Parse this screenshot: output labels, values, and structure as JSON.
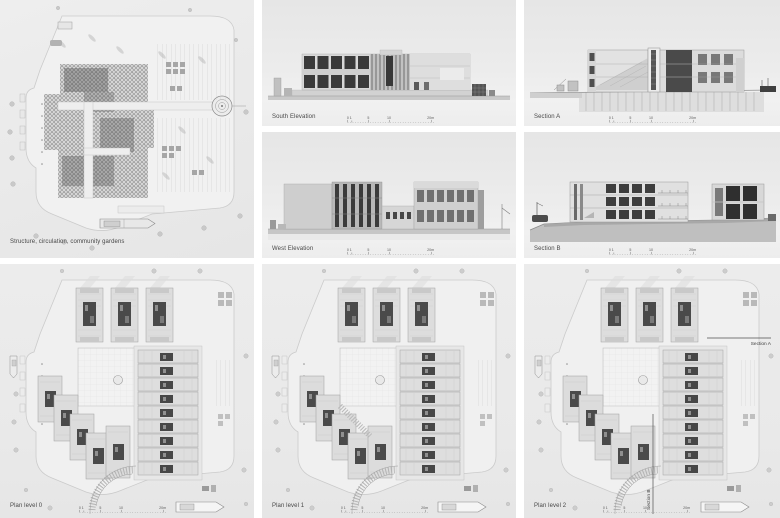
{
  "board": {
    "background": "#ffffff",
    "panel_background": "#ebebeb",
    "ink_color": "#474747",
    "dark_fill": "#434343"
  },
  "panels": {
    "axon": {
      "label": "Structure, circulation, community gardens"
    },
    "south_elevation": {
      "label": "South Elevation"
    },
    "west_elevation": {
      "label": "West Elevation"
    },
    "section_a": {
      "label": "Section A"
    },
    "section_b": {
      "label": "Section B"
    },
    "plan0": {
      "label": "Plan level 0"
    },
    "plan1": {
      "label": "Plan level 1"
    },
    "plan2": {
      "label": "Plan level 2",
      "marker_a": "Section A",
      "marker_b": "Section B"
    }
  },
  "scalebar": {
    "ticks": [
      "0 1",
      "5",
      "10",
      "20m"
    ]
  }
}
